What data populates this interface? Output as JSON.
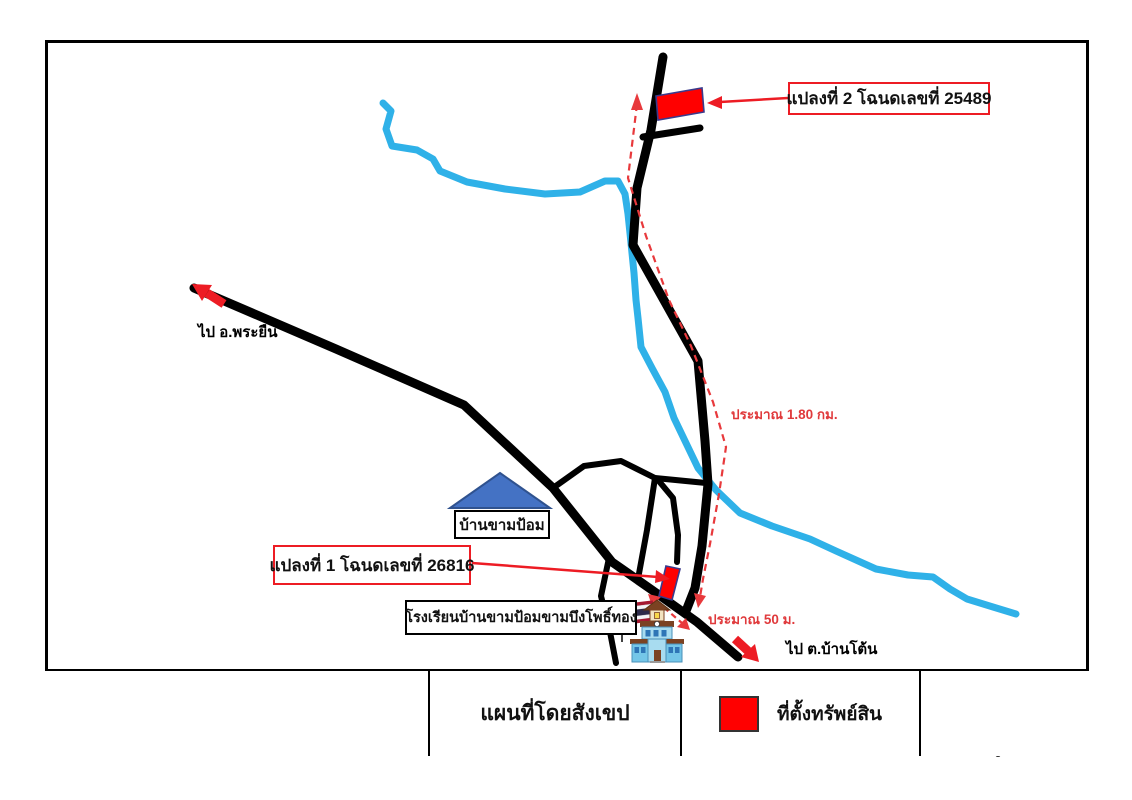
{
  "map": {
    "plot2_label": "แปลงที่ 2 โฉนดเลขที่ 25489",
    "plot1_label": "แปลงที่ 1 โฉนดเลขที่ 26816",
    "village_label": "บ้านขามป้อม",
    "school_label": "โรงเรียนบ้านขามป้อมขามบึงโพธิ์ทอง",
    "direction_west_label": "ไป อ.พระยืน",
    "direction_southeast_label": "ไป ต.บ้านโต้น",
    "distance_long_label": "ประมาณ 1.80 กม.",
    "distance_short_label": "ประมาณ 50 ม."
  },
  "legend": {
    "title": "แผนที่โดยสังเขป",
    "marker_label": "ที่ตั้งทรัพย์สิน"
  },
  "compass": {
    "n": "N",
    "e": "E",
    "s": "S",
    "w": "W",
    "minor": [
      "NNE",
      "ENE",
      "ESE",
      "SSE",
      "SSW",
      "WSW",
      "WNW",
      "NNW"
    ]
  },
  "colors": {
    "road": "#000000",
    "river": "#2FB1E8",
    "parcel_fill": "#FF0000",
    "parcel_border": "#3A3A8C",
    "route_dashed": "#E8393C",
    "red_accent": "#ED1C24",
    "roof_fill": "#4472C4",
    "roof_border": "#2F528F",
    "compass_gold": "#D8B931"
  }
}
